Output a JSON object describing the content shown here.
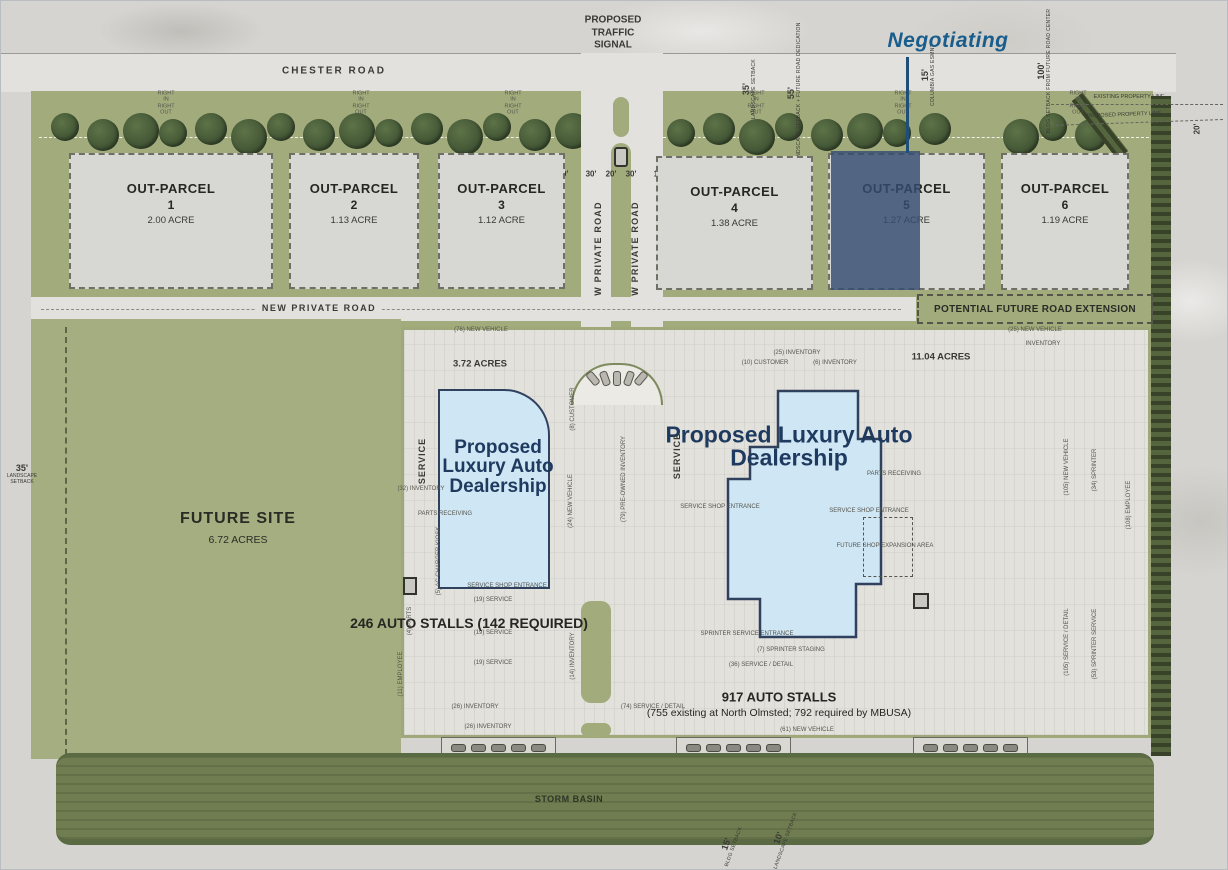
{
  "callout": {
    "label": "Negotiating",
    "color": "#185d8c"
  },
  "top": {
    "traffic_signal": "PROPOSED TRAFFIC SIGNAL",
    "chester_road": "CHESTER ROAD",
    "driveway": {
      "line1": "RIGHT IN",
      "line2": "RIGHT OUT"
    },
    "property_lines": {
      "existing": "EXISTING PROPERTY LINE",
      "proposed": "PROPOSED PROPERTY LINE"
    },
    "right_dim": "20'"
  },
  "median_dims": [
    "10'",
    "30'",
    "20'",
    "30'",
    "10'"
  ],
  "setbacks": [
    {
      "value": "35'",
      "label": "LANDSCAPE SETBACK"
    },
    {
      "value": "55'",
      "label": "LANDSCAPE SETBACK + FUTURE ROAD DEDICATION"
    },
    {
      "value": "15'",
      "label": "COLUMBIA GAS ESMNT"
    },
    {
      "value": "100'",
      "label": "BLDG SETBACK FROM FUTURE ROAD CENTER"
    }
  ],
  "left_setback": {
    "value": "35'",
    "label": "LANDSCAPE SETBACK"
  },
  "bottom_setbacks": [
    {
      "value": "15'",
      "label": "BLDG SETBACK"
    },
    {
      "value": "10'",
      "label": "LANDSCAPE SETBACK"
    }
  ],
  "roads": {
    "new_private_road": "NEW PRIVATE ROAD",
    "future_extension": "POTENTIAL FUTURE ROAD EXTENSION"
  },
  "parcels": [
    {
      "name": "OUT-PARCEL",
      "number": "1",
      "acreage": "2.00 ACRE",
      "highlighted": false
    },
    {
      "name": "OUT-PARCEL",
      "number": "2",
      "acreage": "1.13 ACRE",
      "highlighted": false
    },
    {
      "name": "OUT-PARCEL",
      "number": "3",
      "acreage": "1.12 ACRE",
      "highlighted": false
    },
    {
      "name": "OUT-PARCEL",
      "number": "4",
      "acreage": "1.38 ACRE",
      "highlighted": false
    },
    {
      "name": "OUT-PARCEL",
      "number": "5",
      "acreage": "1.27 ACRE",
      "highlighted": true,
      "status": "Negotiating"
    },
    {
      "name": "OUT-PARCEL",
      "number": "6",
      "acreage": "1.19 ACRE",
      "highlighted": false
    }
  ],
  "future_site": {
    "name": "FUTURE SITE",
    "acreage": "6.72 ACRES"
  },
  "west_campus": {
    "acreage": "3.72 ACRES",
    "service": "SERVICE",
    "building_label": "Proposed Luxury Auto Dealership",
    "stalls": "246 AUTO STALLS (142 REQUIRED)"
  },
  "east_campus": {
    "acreage": "11.04 ACRES",
    "service": "SERVICE",
    "building_label": "Proposed Luxury Auto Dealership",
    "stalls": "917 AUTO STALLS",
    "stalls_note": "(755 existing at North Olmsted; 792 required by MBUSA)"
  },
  "storm_basin": "STORM BASIN",
  "elevated_display": "ELEVATED DISPLAY",
  "colors": {
    "highlight_overlay": "#344c73",
    "building_fill": "#cfe6f4",
    "navy_text": "#1e3a5f",
    "landscape_green": "#a2ab7c",
    "basin_green": "#6f7d50"
  },
  "annotations": [
    {
      "t": "(76) NEW VEHICLE",
      "x": 480,
      "y": 329
    },
    {
      "t": "(8) CUSTOMER",
      "x": 572,
      "y": 408,
      "r": -90
    },
    {
      "t": "(32) INVENTORY",
      "x": 420,
      "y": 488
    },
    {
      "t": "PARTS RECEIVING",
      "x": 444,
      "y": 513
    },
    {
      "t": "(24) NEW VEHICLE",
      "x": 570,
      "y": 500,
      "r": -90
    },
    {
      "t": "(79) PRE-OWNED INVENTORY",
      "x": 623,
      "y": 478,
      "r": -90
    },
    {
      "t": "(5) AC CHARGER KIOSK",
      "x": 438,
      "y": 560,
      "r": -90
    },
    {
      "t": "SERVICE SHOP ENTRANCE",
      "x": 506,
      "y": 585
    },
    {
      "t": "(19) SERVICE",
      "x": 492,
      "y": 599
    },
    {
      "t": "(19) SERVICE",
      "x": 492,
      "y": 632
    },
    {
      "t": "(19) SERVICE",
      "x": 492,
      "y": 662
    },
    {
      "t": "(26) INVENTORY",
      "x": 474,
      "y": 706
    },
    {
      "t": "(26) INVENTORY",
      "x": 487,
      "y": 726
    },
    {
      "t": "(4) PARTS",
      "x": 409,
      "y": 620,
      "r": -90
    },
    {
      "t": "(11) EMPLOYEE",
      "x": 400,
      "y": 673,
      "r": -90
    },
    {
      "t": "(14) INVENTORY",
      "x": 572,
      "y": 655,
      "r": -90
    },
    {
      "t": "(74) SERVICE / DETAIL",
      "x": 652,
      "y": 706
    },
    {
      "t": "(25) INVENTORY",
      "x": 796,
      "y": 352
    },
    {
      "t": "(10) CUSTOMER",
      "x": 764,
      "y": 362
    },
    {
      "t": "(6) INVENTORY",
      "x": 834,
      "y": 362
    },
    {
      "t": "SERVICE SHOP ENTRANCE",
      "x": 719,
      "y": 506
    },
    {
      "t": "SERVICE SHOP ENTRANCE",
      "x": 868,
      "y": 510
    },
    {
      "t": "PARTS RECEIVING",
      "x": 893,
      "y": 473
    },
    {
      "t": "FUTURE SHOP EXPANSION AREA",
      "x": 884,
      "y": 545
    },
    {
      "t": "SPRINTER SERVICE ENTRANCE",
      "x": 746,
      "y": 633
    },
    {
      "t": "(7) SPRINTER STAGING",
      "x": 790,
      "y": 649
    },
    {
      "t": "(36) SERVICE / DETAIL",
      "x": 760,
      "y": 664
    },
    {
      "t": "(61) NEW VEHICLE",
      "x": 806,
      "y": 729
    },
    {
      "t": "(25) NEW VEHICLE",
      "x": 1034,
      "y": 329
    },
    {
      "t": "INVENTORY",
      "x": 1042,
      "y": 343
    },
    {
      "t": "(105) NEW VEHICLE",
      "x": 1066,
      "y": 466,
      "r": -90
    },
    {
      "t": "(34) SPRINTER",
      "x": 1094,
      "y": 469,
      "r": -90
    },
    {
      "t": "(108) EMPLOYEE",
      "x": 1128,
      "y": 504,
      "r": -90
    },
    {
      "t": "(105) SERVICE / DETAIL",
      "x": 1066,
      "y": 641,
      "r": -90
    },
    {
      "t": "(53) SPRINTER SERVICE",
      "x": 1094,
      "y": 643,
      "r": -90
    }
  ]
}
